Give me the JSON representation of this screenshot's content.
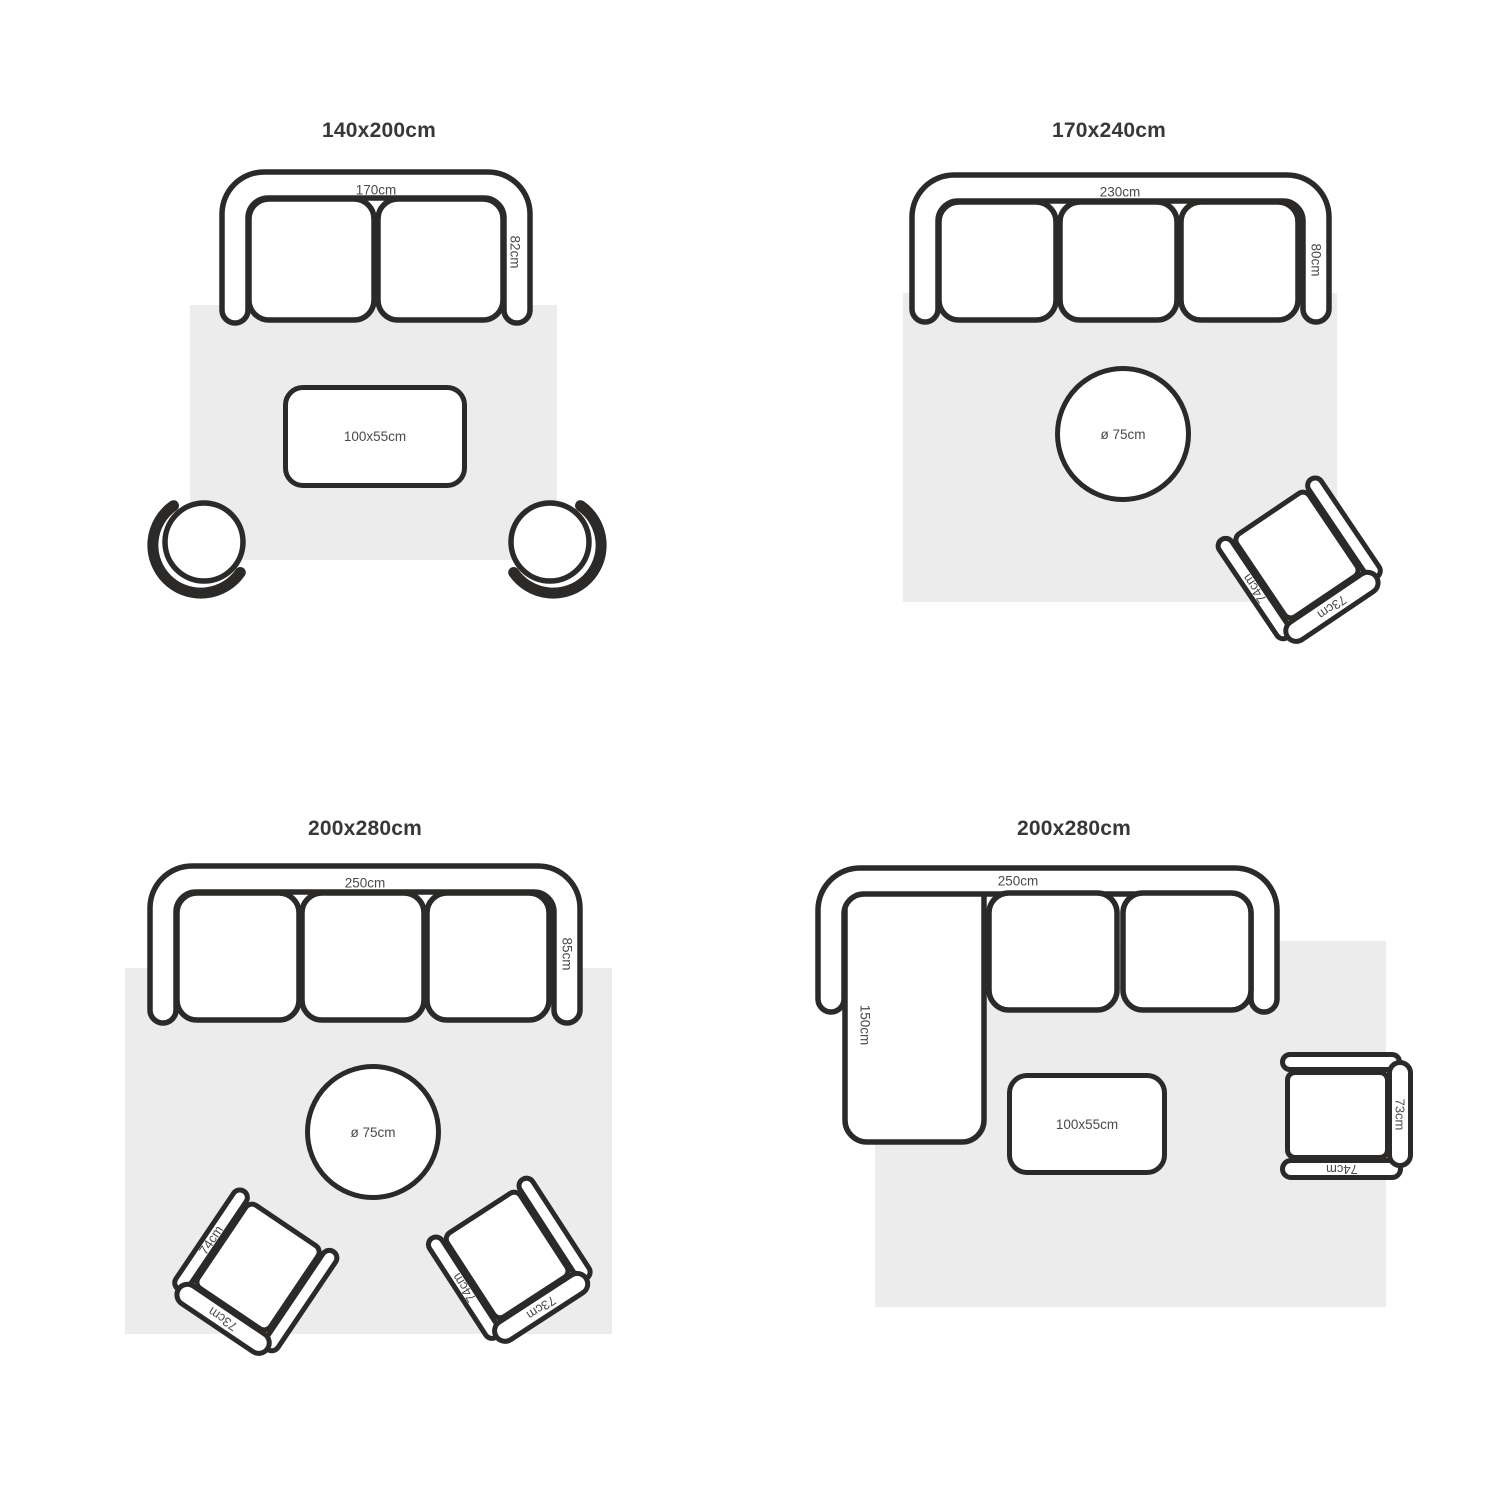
{
  "colors": {
    "outline": "#2b2a29",
    "rug": "#ececec",
    "label_text": "#4a4a49",
    "title_text": "#383837"
  },
  "quadrants": [
    {
      "title": "140x200cm",
      "sofa_width": "170cm",
      "sofa_depth": "82cm",
      "table": "100x55cm"
    },
    {
      "title": "170x240cm",
      "sofa_width": "230cm",
      "sofa_depth": "80cm",
      "table": "ø 75cm",
      "chair_arm": "74cm",
      "chair_back": "73cm"
    },
    {
      "title": "200x280cm",
      "sofa_width": "250cm",
      "sofa_depth": "85cm",
      "table": "ø 75cm",
      "chair1_arm": "74cm",
      "chair1_back": "73cm",
      "chair2_arm": "74cm",
      "chair2_back": "73cm"
    },
    {
      "title": "200x280cm",
      "sofa_width": "250cm",
      "chaise_depth": "150cm",
      "table": "100x55cm",
      "chair_arm": "74cm",
      "chair_back": "73cm"
    }
  ]
}
